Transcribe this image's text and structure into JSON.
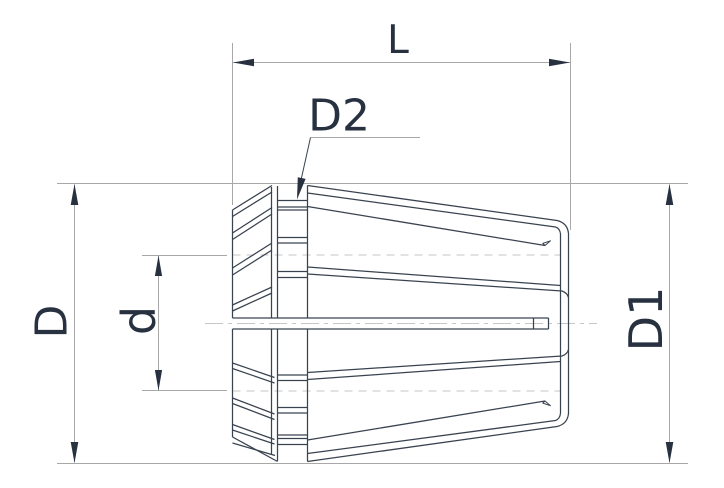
{
  "drawing": {
    "type": "collet-side-view-technical-drawing",
    "labels": {
      "total_length": "L",
      "groove_diameter": "D2",
      "front_diameter": "D",
      "bore_diameter": "d",
      "body_diameter": "D1"
    },
    "colors": {
      "part_line": "#39434f",
      "annotation_text": "#273140",
      "helper_line": "#a8a8a8",
      "hidden_line": "#c6c6c6",
      "background": "#ffffff"
    }
  }
}
